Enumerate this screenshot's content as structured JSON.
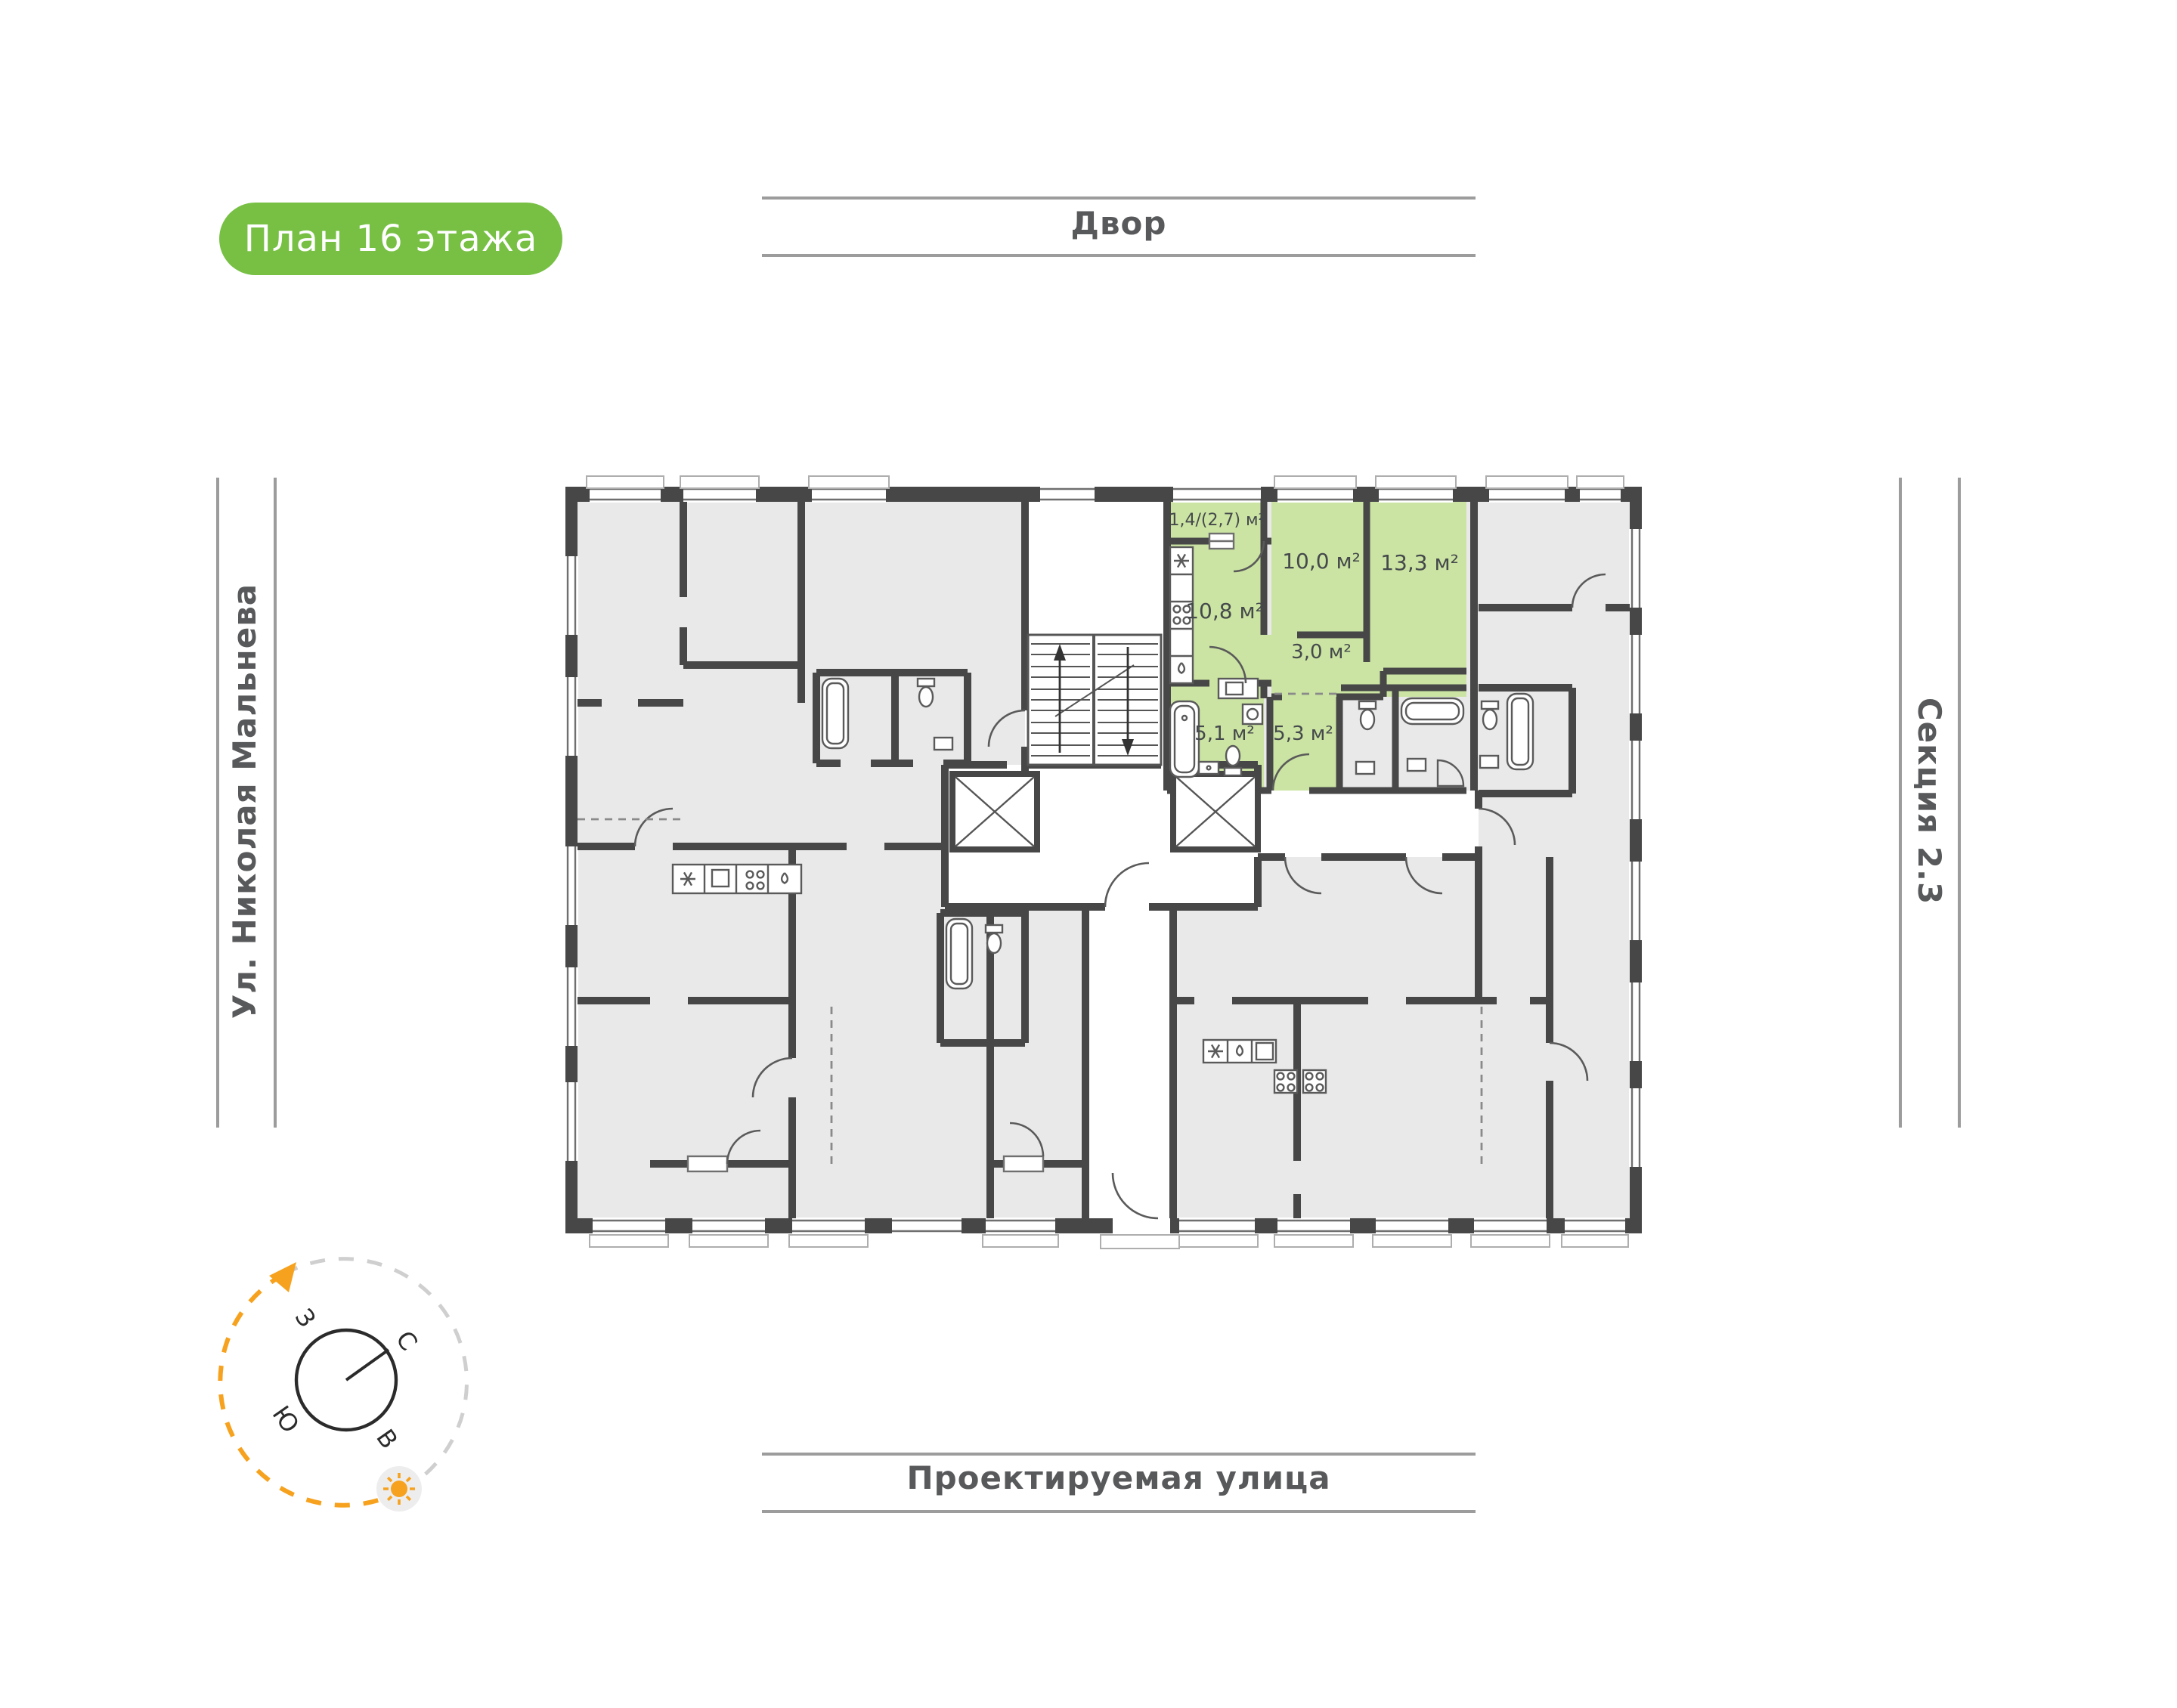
{
  "badge": {
    "label": "План 16 этажа"
  },
  "surroundings": {
    "top": "Двор",
    "bottom": "Проектируемая улица",
    "left": "Ул. Николая Мальнева",
    "right": "Секция 2.3"
  },
  "apartment": {
    "status": "highlighted",
    "rooms": [
      {
        "name": "balcony",
        "area": "1,4/(2,7) м²"
      },
      {
        "name": "kitchen",
        "area": "10,8 м²"
      },
      {
        "name": "room-1",
        "area": "10,0 м²"
      },
      {
        "name": "room-2",
        "area": "13,3 м²"
      },
      {
        "name": "hallway",
        "area": "3,0 м²"
      },
      {
        "name": "bathroom",
        "area": "5,1 м²"
      },
      {
        "name": "hall",
        "area": "5,3 м²"
      }
    ]
  },
  "compass": {
    "north": "С",
    "south": "Ю",
    "west": "З",
    "east": "В"
  },
  "colors": {
    "accent_green": "#77c044",
    "apartment_green": "#cbe4a3",
    "wall_dark": "#474747",
    "floor_gray": "#e9e9e9",
    "rule_gray": "#9c9c9c",
    "text_gray": "#58595b",
    "compass_orange": "#f6a21e"
  }
}
